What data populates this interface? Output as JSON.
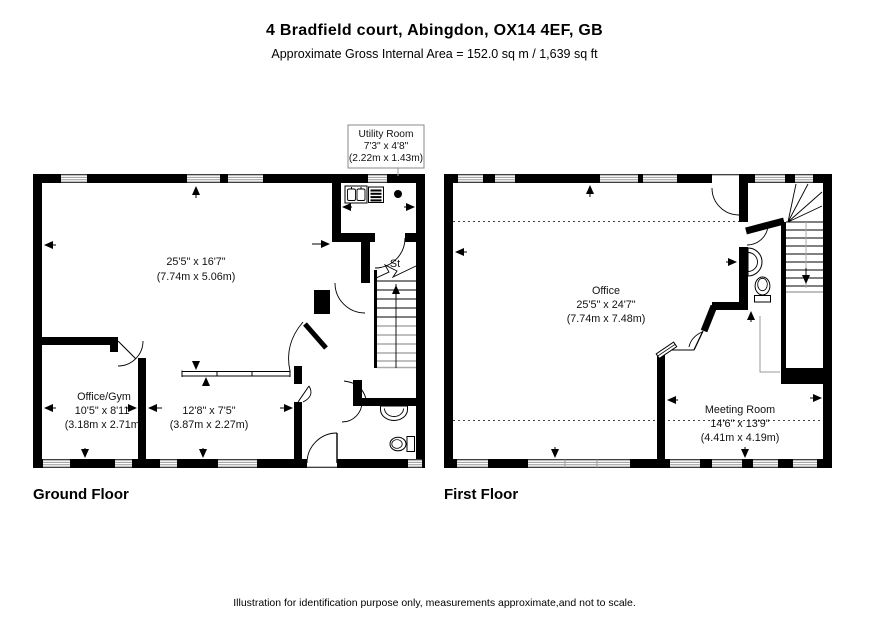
{
  "header": {
    "title": "4 Bradfield court, Abingdon, OX14 4EF, GB",
    "subtitle": "Approximate Gross Internal Area = 152.0 sq m / 1,639 sq ft"
  },
  "ground_floor": {
    "label": "Ground Floor",
    "utility_room": {
      "name": "Utility Room",
      "size_imperial": "7'3\" x 4'8\"",
      "size_metric": "(2.22m x 1.43m)"
    },
    "main_area": {
      "size_imperial": "25'5\" x 16'7\"",
      "size_metric": "(7.74m x 5.06m)"
    },
    "storage_label": "St",
    "office_gym": {
      "name": "Office/Gym",
      "size_imperial": "10'5\" x 8'11\"",
      "size_metric": "(3.18m x 2.71m)"
    },
    "rear_room": {
      "size_imperial": "12'8\" x 7'5\"",
      "size_metric": "(3.87m x 2.27m)"
    }
  },
  "first_floor": {
    "label": "First Floor",
    "office": {
      "name": "Office",
      "size_imperial": "25'5\" x 24'7\"",
      "size_metric": "(7.74m x 7.48m)"
    },
    "meeting_room": {
      "name": "Meeting Room",
      "size_imperial": "14'6\" x 13'9\"",
      "size_metric": "(4.41m x 4.19m)"
    }
  },
  "footer": {
    "disclaimer": "Illustration for identification purpose only, measurements approximate,and not to scale."
  },
  "colors": {
    "wall": "#000000",
    "background": "#ffffff",
    "window_line": "#999999",
    "stair_faint": "#aaaaaa"
  }
}
